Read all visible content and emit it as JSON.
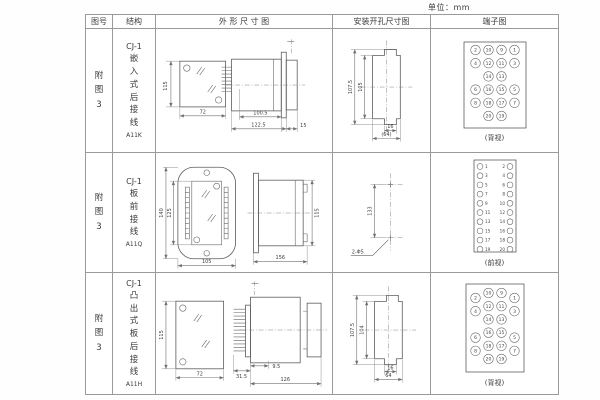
{
  "unit_label": "单位：mm",
  "headers": {
    "figure": "图号",
    "structure": "结构",
    "outline": "外 形 尺 寸 图",
    "mounting": "安装开孔尺寸图",
    "terminal": "端子图"
  },
  "rows": [
    {
      "figure": "附图3",
      "structure": {
        "model": "CJ-1",
        "desc": "嵌入式后接线",
        "code": "A11K"
      },
      "outline": {
        "height": "115",
        "width": "72",
        "depth": "100.5",
        "total_depth": "122.5",
        "flange": "15"
      },
      "mounting": {
        "outer": "107.5",
        "inner": "105",
        "notch": "16",
        "width": "(64)"
      },
      "terminal": {
        "view": "(背视)",
        "grid": [
          [
            "2",
            "10",
            "9",
            "1"
          ],
          [
            "4",
            "12",
            "11",
            "3"
          ],
          [
            "",
            "14",
            "13",
            ""
          ],
          [
            "6",
            "16",
            "15",
            "5"
          ],
          [
            "8",
            "18",
            "17",
            "7"
          ],
          [
            "",
            "20",
            "19",
            ""
          ]
        ]
      }
    },
    {
      "figure": "附图3",
      "structure": {
        "model": "CJ-1",
        "desc": "板前接线",
        "code": "A11Q"
      },
      "outline": {
        "outer_height": "140",
        "inner_height": "125",
        "width": "105",
        "length": "156",
        "height": "115"
      },
      "mounting": {
        "spacing": "133",
        "holes": "2-Φ5"
      },
      "terminal": {
        "view": "(前视)",
        "left": [
          "1",
          "3",
          "5",
          "7",
          "9",
          "11",
          "13",
          "15",
          "17",
          "19"
        ],
        "right": [
          "2",
          "4",
          "6",
          "8",
          "10",
          "12",
          "14",
          "16",
          "18",
          "20"
        ]
      }
    },
    {
      "figure": "附图3",
      "structure": {
        "model": "CJ-1",
        "desc": "凸出式板后接线",
        "code": "A11H"
      },
      "outline": {
        "height": "115",
        "width": "72",
        "pin_len": "31.5",
        "offset": "9.5",
        "length": "126"
      },
      "mounting": {
        "outer": "107.5",
        "inner": "104",
        "notch": "16",
        "width": "64"
      },
      "terminal": {
        "view": "(背视)",
        "grid": [
          [
            "2",
            "10",
            "9",
            "1"
          ],
          [
            "4",
            "12",
            "11",
            "3"
          ],
          [
            "",
            "14",
            "13",
            ""
          ],
          [
            "6",
            "16",
            "15",
            "5"
          ],
          [
            "8",
            "18",
            "17",
            "7"
          ],
          [
            "",
            "20",
            "19",
            ""
          ]
        ]
      }
    }
  ]
}
